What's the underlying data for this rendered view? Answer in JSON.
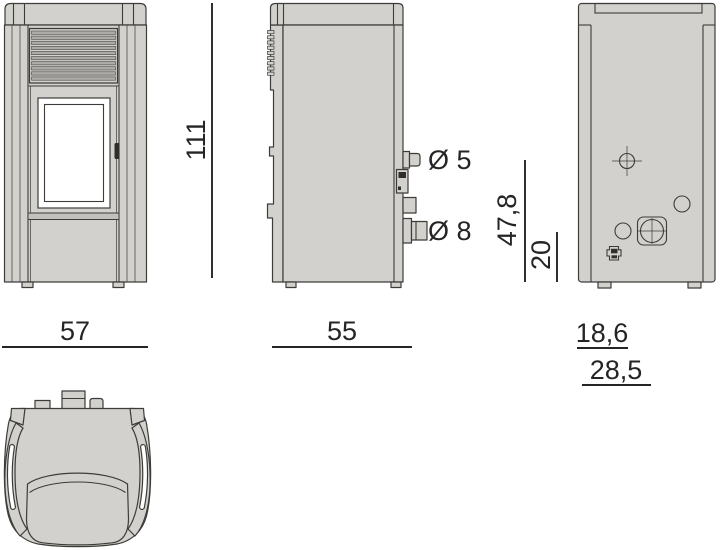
{
  "drawing": {
    "kind": "pellet-stove-dimensional-drawing",
    "views": [
      "front",
      "side",
      "back",
      "top"
    ]
  },
  "colors": {
    "background": "#ffffff",
    "body_fill": "#d2d1cd",
    "slat_fill": "#acaba7",
    "band_fill": "#c2c1bd",
    "outline": "#3d3c39",
    "dark_detail": "#2f2e2c",
    "glass": "#ffffff",
    "dim_color": "#262424"
  },
  "dimensions": {
    "height": "111",
    "front_width": "57",
    "side_depth": "55",
    "upper_pipe_diameter": "Ø 5",
    "lower_pipe_diameter": "Ø 8",
    "back_upper_height": "47,8",
    "back_lower_height": "20",
    "back_upper_offset": "18,6",
    "back_lower_offset": "28,5"
  }
}
